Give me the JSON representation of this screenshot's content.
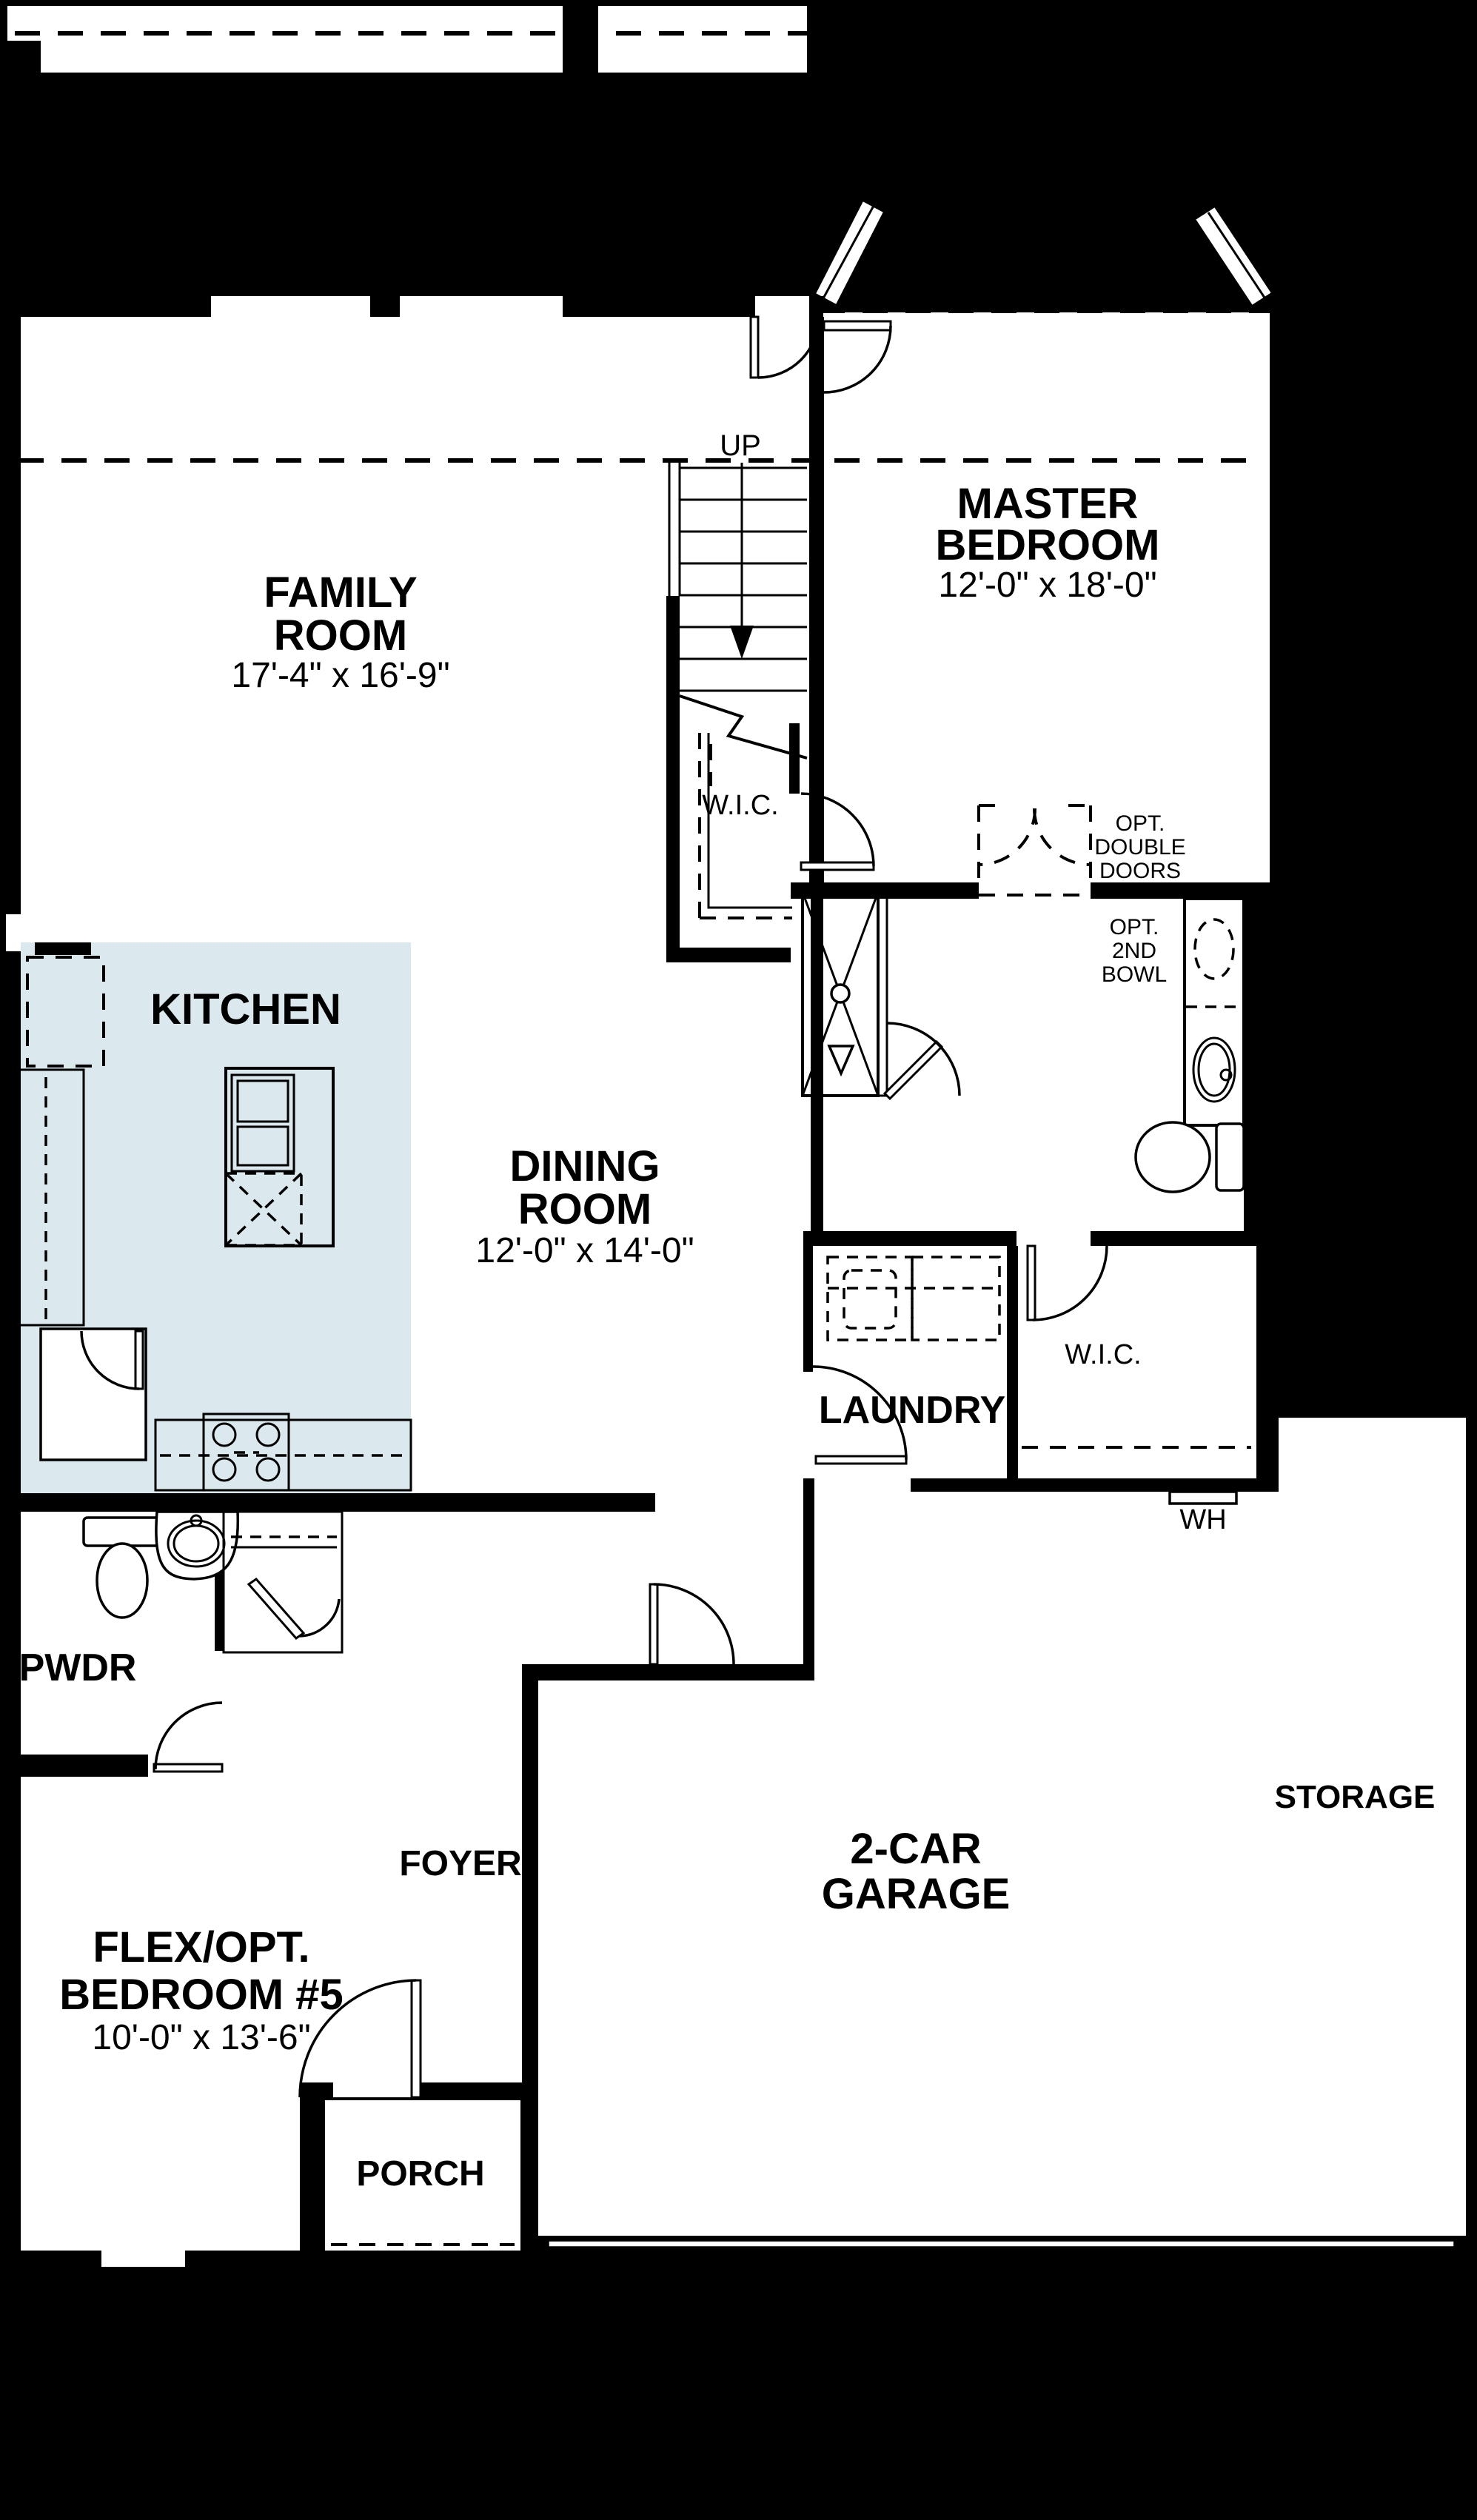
{
  "colors": {
    "background": "#000000",
    "floor": "#ffffff",
    "patio_fill": "#dbe8ed",
    "wall": "#000000"
  },
  "rooms": {
    "covered_patio": {
      "line1": "COVERED",
      "line2": "PATIO"
    },
    "family_room": {
      "line1": "FAMILY",
      "line2": "ROOM",
      "dims": "17'-4\" x 16'-9\""
    },
    "master_bedroom": {
      "line1": "MASTER",
      "line2": "BEDROOM",
      "dims": "12'-0\" x 18'-0\""
    },
    "dining_room": {
      "line1": "DINING",
      "line2": "ROOM",
      "dims": "12'-0\" x 14'-0\""
    },
    "kitchen": {
      "label": "KITCHEN"
    },
    "wic_master": {
      "label": "W.I.C."
    },
    "wic_hall": {
      "label": "W.I.C."
    },
    "laundry": {
      "label": "LAUNDRY"
    },
    "pwdr": {
      "label": "PWDR"
    },
    "foyer": {
      "label": "FOYER"
    },
    "garage": {
      "line1": "2-CAR",
      "line2": "GARAGE"
    },
    "storage": {
      "label": "STORAGE"
    },
    "flex_bedroom": {
      "line1": "FLEX/OPT.",
      "line2": "BEDROOM #5",
      "dims": "10'-0\" x 13'-6\""
    },
    "porch": {
      "label": "PORCH"
    }
  },
  "annotations": {
    "stairs": "UP",
    "water_heater": "WH",
    "opt_double_doors": {
      "line1": "OPT.",
      "line2": "DOUBLE",
      "line3": "DOORS"
    },
    "opt_2nd_bowl": {
      "line1": "OPT.",
      "line2": "2ND",
      "line3": "BOWL"
    }
  }
}
